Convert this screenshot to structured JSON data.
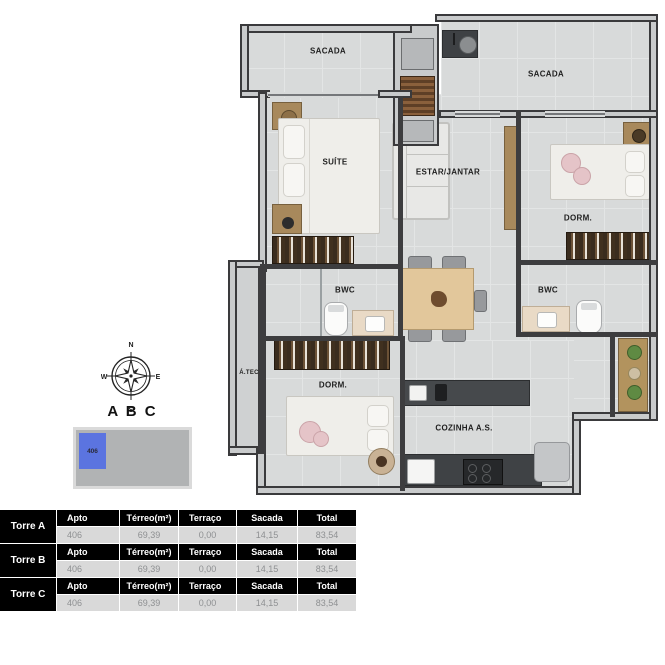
{
  "plan": {
    "rooms": {
      "sacada_left": "SACADA",
      "sacada_right": "SACADA",
      "suite": "SUÍTE",
      "estar_jantar": "ESTAR/JANTAR",
      "dorm_right": "DORM.",
      "bwc_left": "BWC",
      "bwc_right": "BWC",
      "area_tecnica": "Á.TEC",
      "dorm_bottom": "DORM.",
      "cozinha": "COZINHA A.S."
    }
  },
  "compass": {
    "north": "N",
    "east": "E",
    "south": "S",
    "west": "W"
  },
  "key": {
    "towers": "A B C",
    "unit": "406",
    "highlight_color": "#5b74e0"
  },
  "table": {
    "headers": [
      "Apto",
      "Térreo(m²)",
      "Terraço",
      "Sacada",
      "Total"
    ],
    "groups": [
      {
        "tower": "Torre A",
        "values": [
          "406",
          "69,39",
          "0,00",
          "14,15",
          "83,54"
        ]
      },
      {
        "tower": "Torre B",
        "values": [
          "406",
          "69,39",
          "0,00",
          "14,15",
          "83,54"
        ]
      },
      {
        "tower": "Torre C",
        "values": [
          "406",
          "69,39",
          "0,00",
          "14,15",
          "83,54"
        ]
      }
    ]
  }
}
